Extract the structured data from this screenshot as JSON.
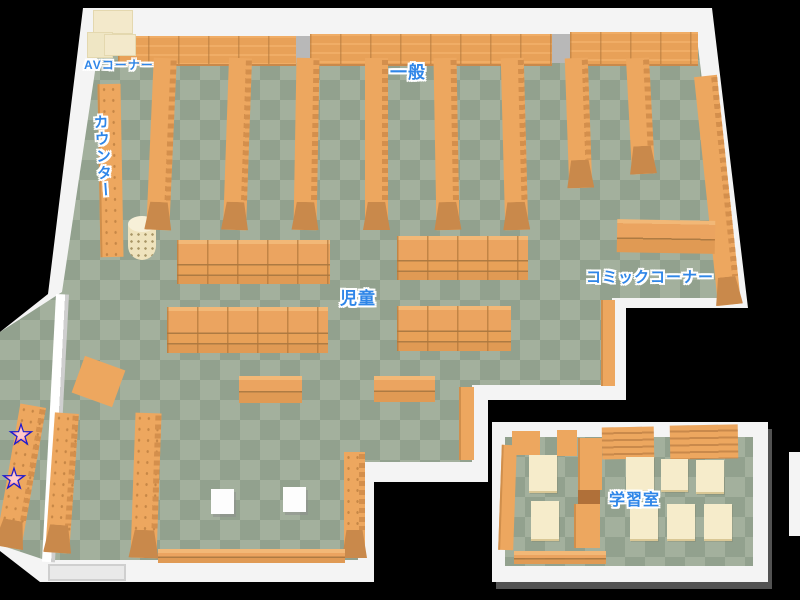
{
  "page": {
    "type": "library-floor-map",
    "background": "#000000"
  },
  "labels": {
    "av_corner": "AVコーナー",
    "general": "一般",
    "counter": "カウンター",
    "children": "児童",
    "comic_corner": "コミックコーナー",
    "study_room": "学習室"
  },
  "markers": {
    "star_count": 2
  },
  "colors": {
    "label_text": "#2f86e8",
    "label_outline": "#ffffff",
    "shelf_orange": "#eda75f",
    "shelf_front_dark": "#c9894b",
    "floor_light": "#a3b09d",
    "floor_dark": "#92a18e",
    "wall_white": "#f4f4f4",
    "window_gap_gray": "#b8b8b8",
    "cream_furniture": "#f3e9cb",
    "table_cream": "#f6eccb",
    "star_fill": "#f0506a",
    "star_outline": "#1b1bd0"
  }
}
